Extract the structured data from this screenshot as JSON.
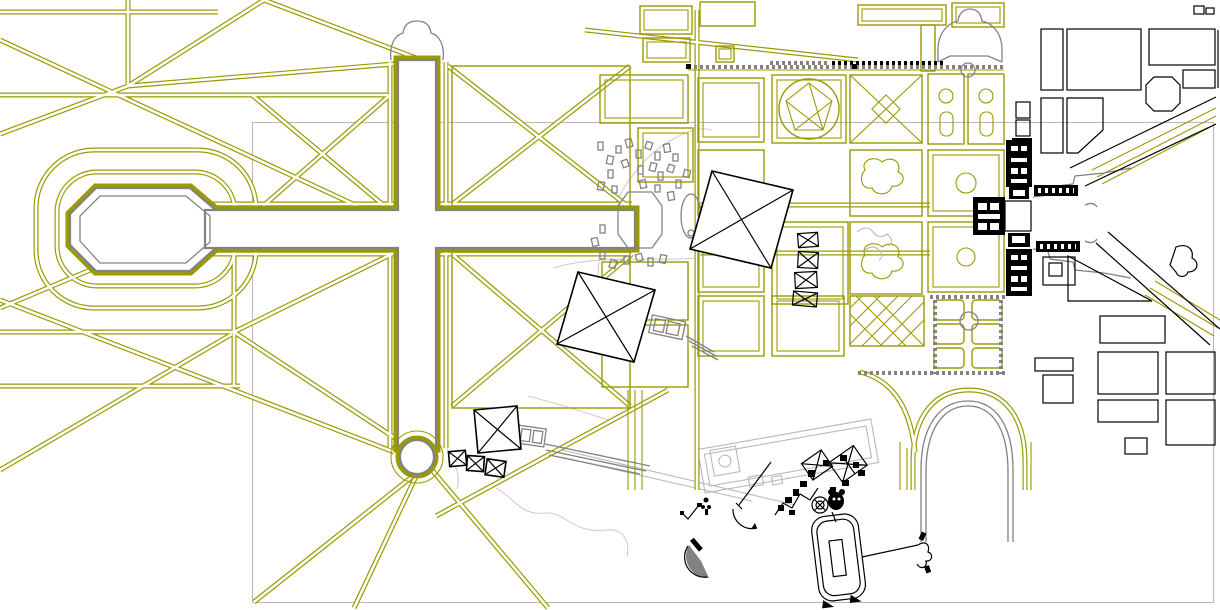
{
  "canvas": {
    "width": 1220,
    "height": 610,
    "background": "#ffffff"
  },
  "palette": {
    "olive": "#9a9a00",
    "olive_dark": "#6f6f00",
    "black": "#000000",
    "gray": "#828282",
    "gray_light": "#b9b9b9",
    "pink": "#d9c7d9",
    "white": "#ffffff"
  },
  "drawing": {
    "kind": "cad-site-plan",
    "visible_text": "",
    "layers": [
      {
        "name": "garden-avenue-network",
        "color": "#9a9a00"
      },
      {
        "name": "grand-canal-cross",
        "color": "#828282"
      },
      {
        "name": "parterre-compartments",
        "color": "#9a9a00"
      },
      {
        "name": "palace-buildings",
        "color": "#000000"
      },
      {
        "name": "town-street-grid",
        "color": "#000000"
      },
      {
        "name": "survey-markers",
        "color": "#000000"
      },
      {
        "name": "viewport-frame",
        "color": "#b9b9b9"
      },
      {
        "name": "faint-paths",
        "color": "#d9c7d9"
      }
    ],
    "marker_counts": {
      "x_square_markers": 3,
      "small_x_boxes": 3
    }
  }
}
